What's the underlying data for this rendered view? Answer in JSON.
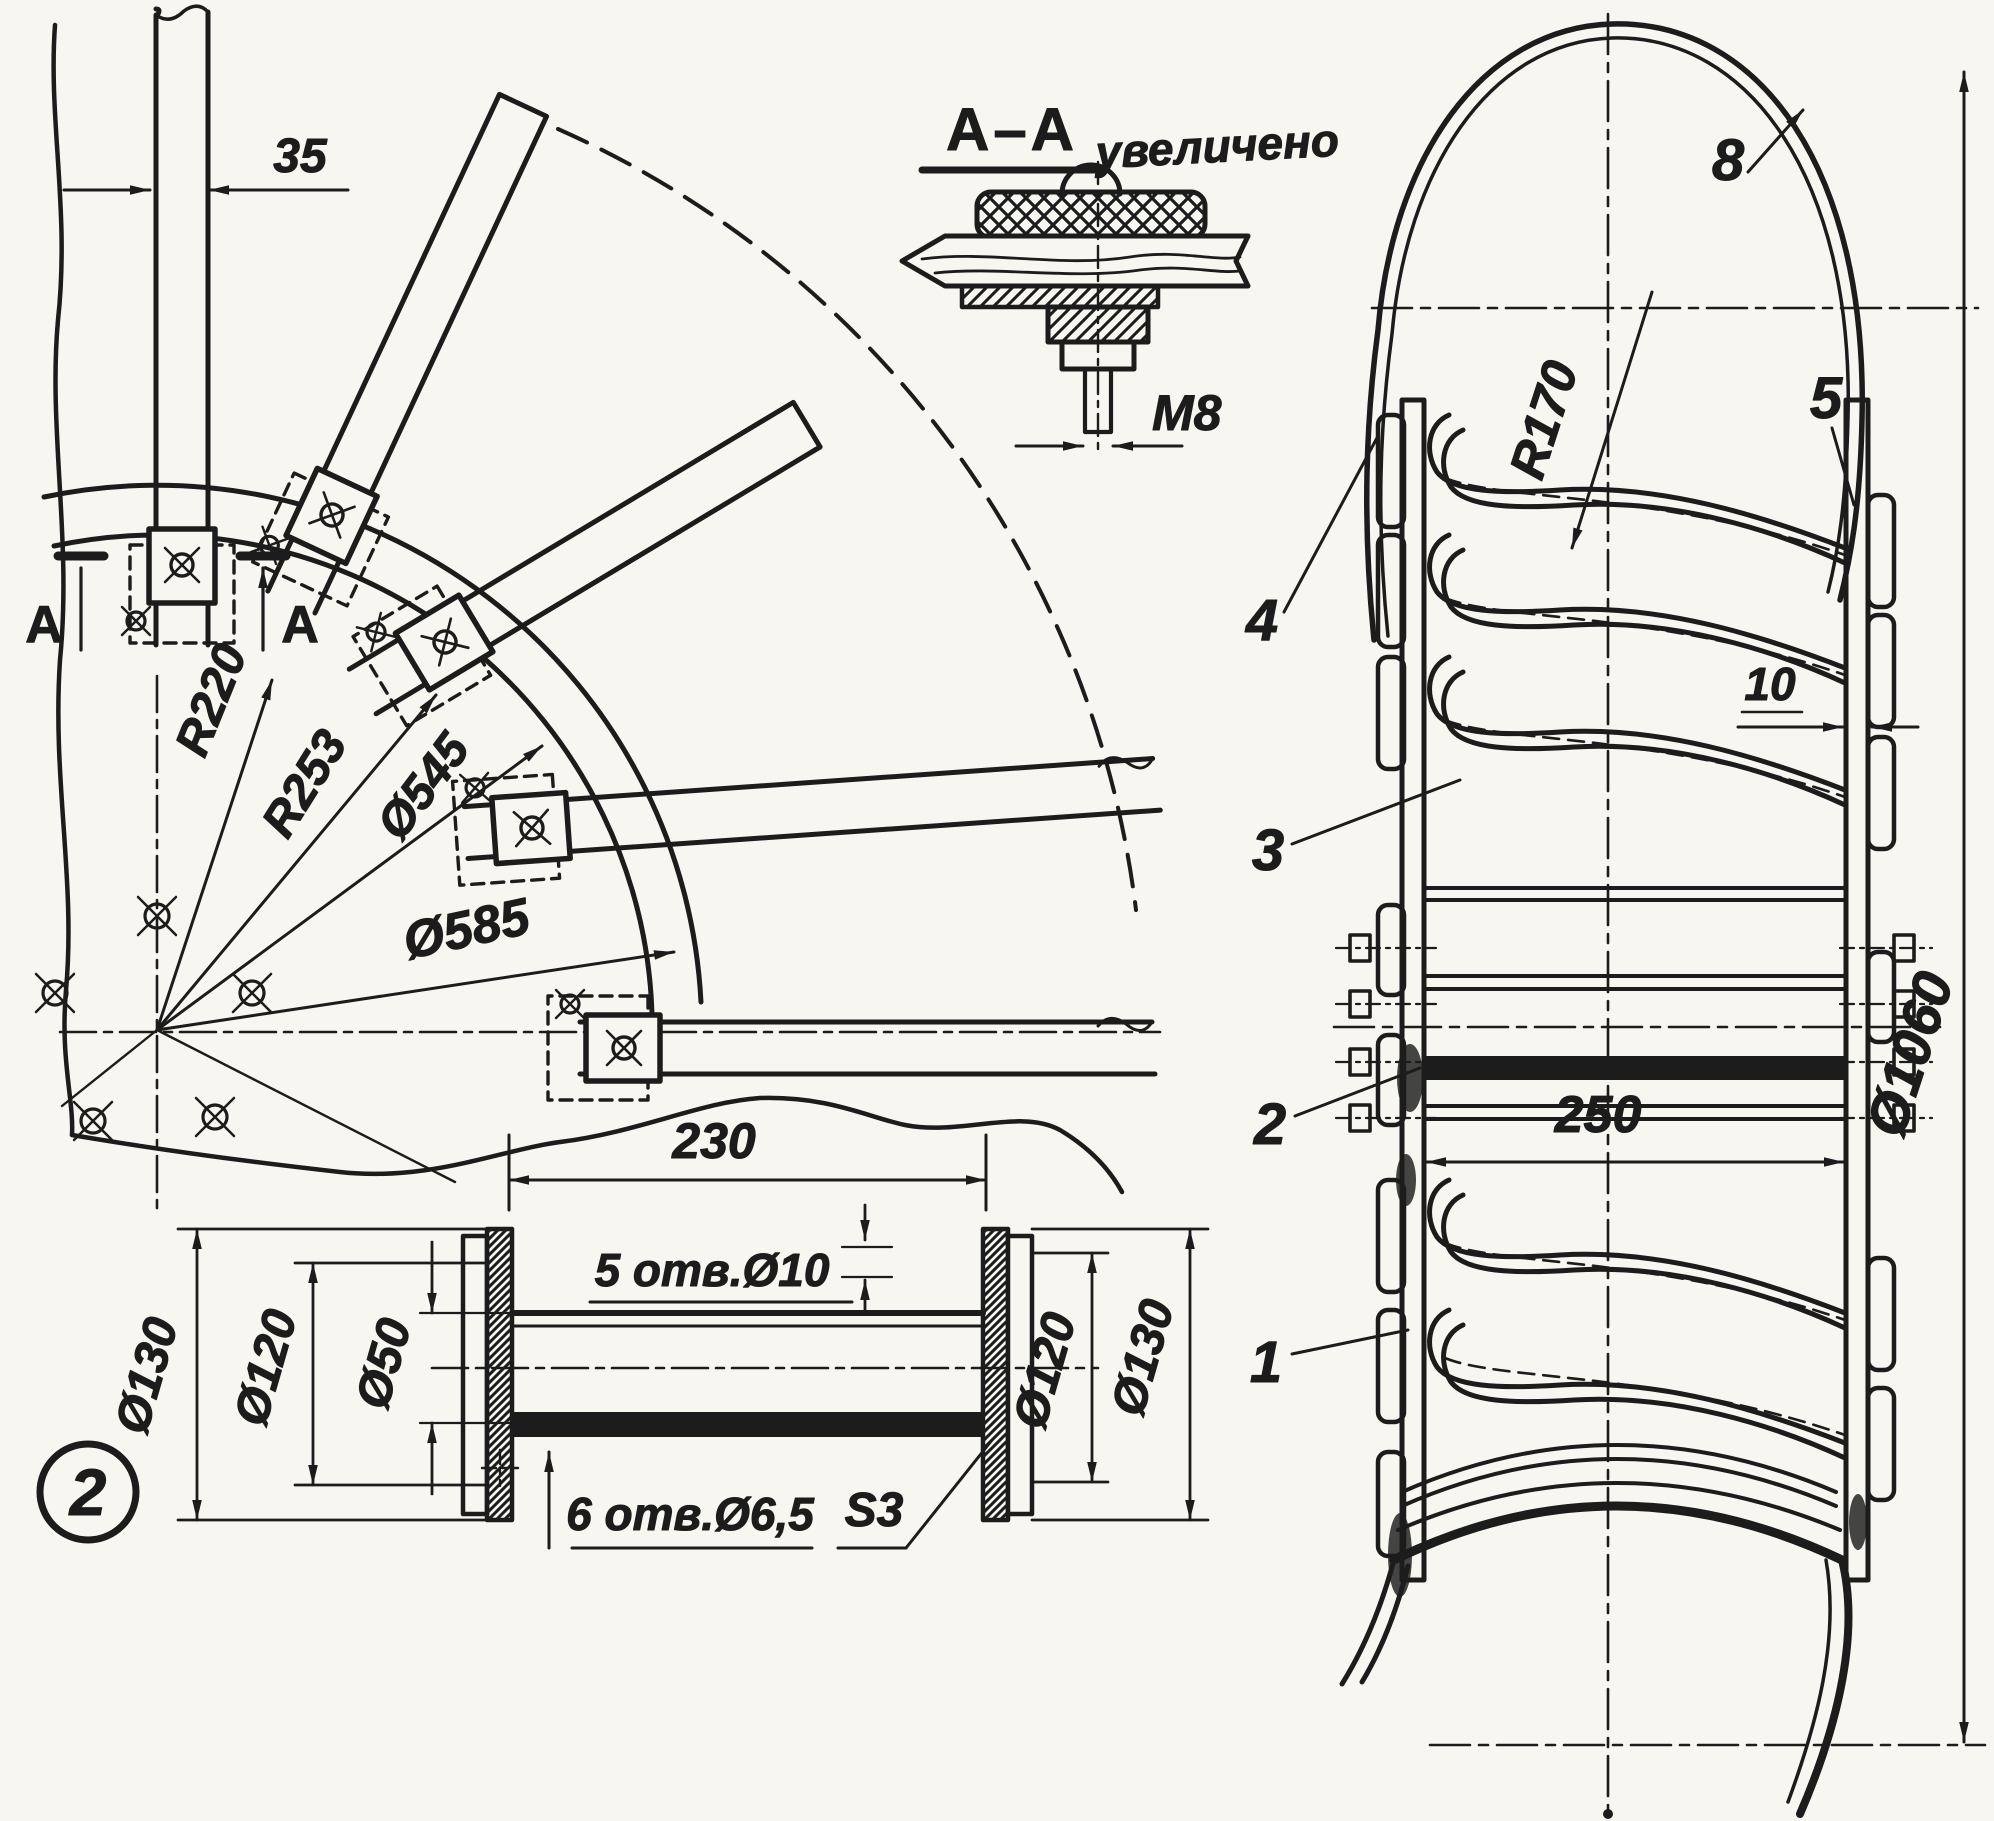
{
  "figure": {
    "callout_number": "2"
  },
  "colors": {
    "paper": "#f8f6f0",
    "ink": "#1c1c1c"
  },
  "section_detail": {
    "title": "А–А",
    "note": "увеличено",
    "thread": "М8"
  },
  "plan_view": {
    "spoke_width": "35",
    "radius_inner": "R220",
    "radius_outer": "R253",
    "dia_clamp_circle": "Ø545",
    "dia_rim": "Ø585",
    "section_letter_left": "А",
    "section_letter_right": "А"
  },
  "hub_detail": {
    "length": "230",
    "holes_top": "5 отв.Ø10",
    "holes_bottom": "6 отв.Ø6,5",
    "sheet_thickness": "S3",
    "dia_flange_left_outer": "Ø130",
    "dia_flange_left_bolt": "Ø120",
    "dia_tube": "Ø50",
    "dia_flange_right_bolt": "Ø120",
    "dia_flange_right_outer": "Ø130"
  },
  "side_view": {
    "blade_radius": "R170",
    "strip_thickness": "10",
    "hub_width": "250",
    "dia_tire": "Ø1060",
    "part_tire": "4",
    "part_strip_right": "5",
    "part_tube": "8",
    "part_blade": "3",
    "part_bolt": "2",
    "part_strip_left": "1"
  }
}
